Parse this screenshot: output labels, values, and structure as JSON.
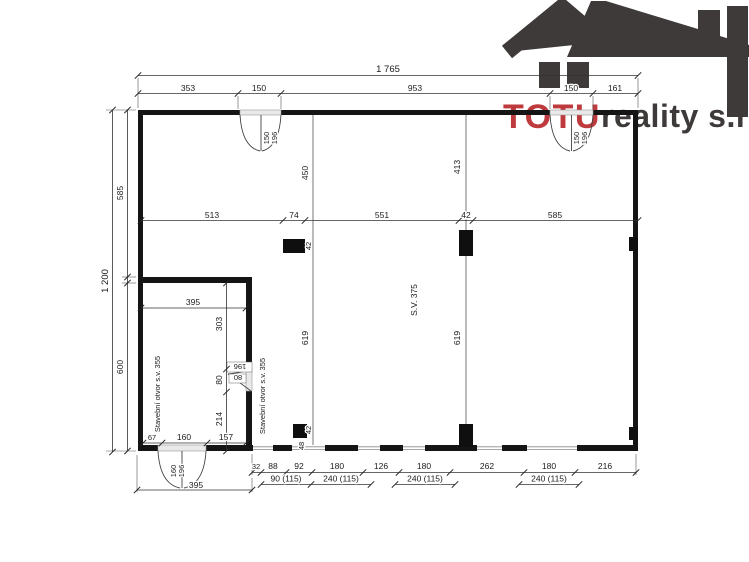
{
  "logo": {
    "brand": "TOTU",
    "company": "reality s.r.o.",
    "brand_color": "#bf3a3c",
    "icon_color": "#3e3a3a",
    "icon": "house-roof-icon"
  },
  "top_dims": {
    "total": "1 765",
    "segments": [
      "353",
      "150",
      "953",
      "150",
      "161"
    ]
  },
  "left_dims": {
    "total": "1 200",
    "segments": [
      "585",
      "600"
    ]
  },
  "mid_dims": {
    "segments": [
      "513",
      "74",
      "551",
      "42",
      "585"
    ],
    "column_width": "42"
  },
  "vertical_dims": {
    "left_upper": "450",
    "right_upper": "413",
    "left_lower": "619",
    "right_lower": "619"
  },
  "hall": {
    "clear_height": "S.V. 375"
  },
  "room": {
    "width": "395",
    "vertical_segments": [
      "303",
      "80",
      "214"
    ],
    "bottom_segments": [
      "67",
      "160",
      "157"
    ],
    "opening_label_left": "Stavební otvor s.v. 355",
    "opening_label_right": "Stavební otvor s.v. 355",
    "door": {
      "width": "80",
      "height": "196"
    }
  },
  "doors": {
    "top_left": {
      "width": "150",
      "height": "196"
    },
    "top_right": {
      "width": "150",
      "height": "196"
    },
    "bottom": {
      "width": "160",
      "height": "196",
      "overall": "395"
    }
  },
  "bottom_dims": {
    "row1": [
      "32",
      "88",
      "92",
      "180",
      "126",
      "180",
      "262",
      "180",
      "216"
    ],
    "row2": [
      "90 (115)",
      "240 (115)",
      "240 (115)",
      "240 (115)"
    ],
    "column": {
      "width": "42",
      "offset": "48"
    }
  }
}
